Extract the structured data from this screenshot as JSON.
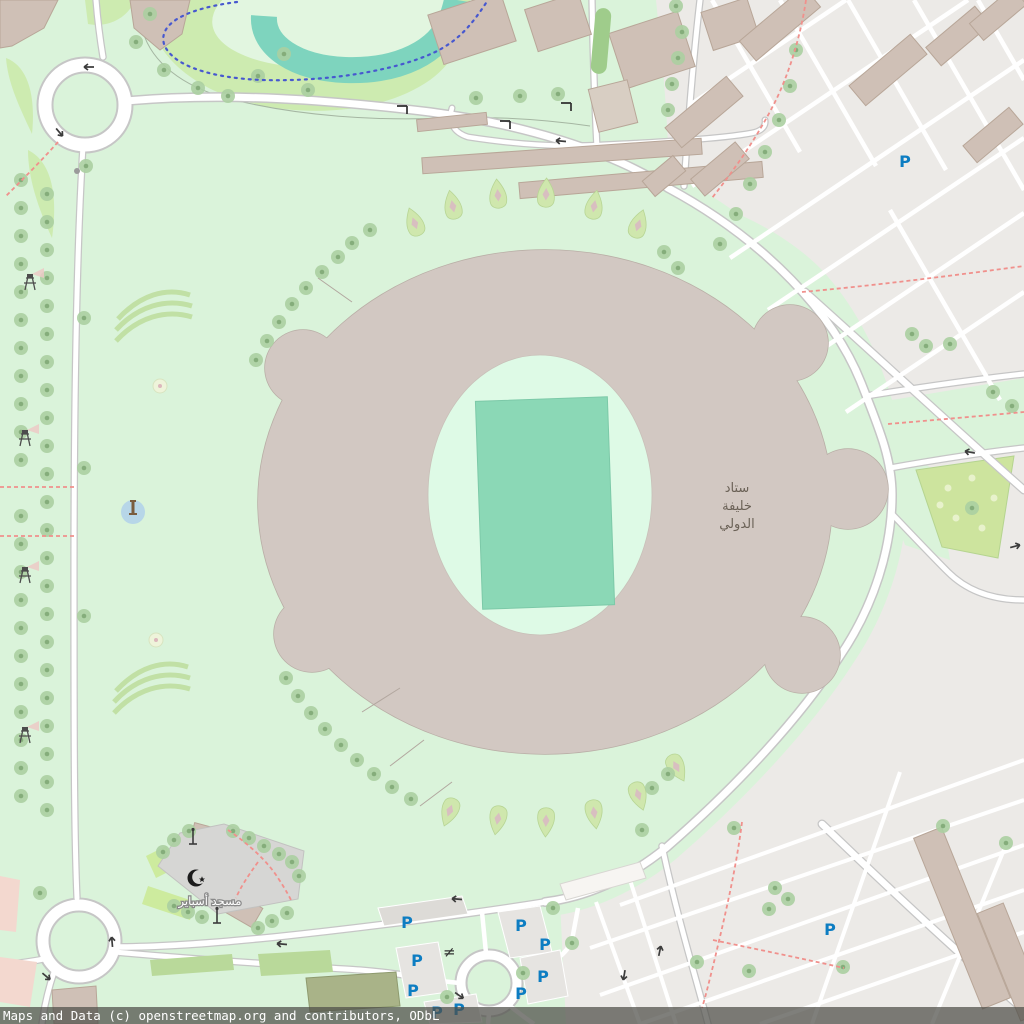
{
  "attribution": "Maps and Data (c) openstreetmap.org and contributors, ODbL",
  "labels": {
    "stadium_line1": "ستاد",
    "stadium_line2": "خليفة",
    "stadium_line3": "الدولي",
    "mosque": "مسجد أسباير",
    "parking": "P"
  },
  "colors": {
    "park_green": "#daf3da",
    "grass_green": "#cdebb0",
    "water_teal": "#7ed4be",
    "pitch_green": "#8bd8b6",
    "stadium_fill": "#d2c8c2",
    "building_tan": "#cfc0b6",
    "residential_gray": "#eceae7",
    "road_white": "#ffffff",
    "road_casing": "#c6c6c6",
    "footpath_red": "#f0908c",
    "cycleway_blue": "#4758cf",
    "parking_blue": "#0d7dc2",
    "stadium_label_gray": "#6b6257",
    "fountain_blue": "#b7d6e8"
  }
}
